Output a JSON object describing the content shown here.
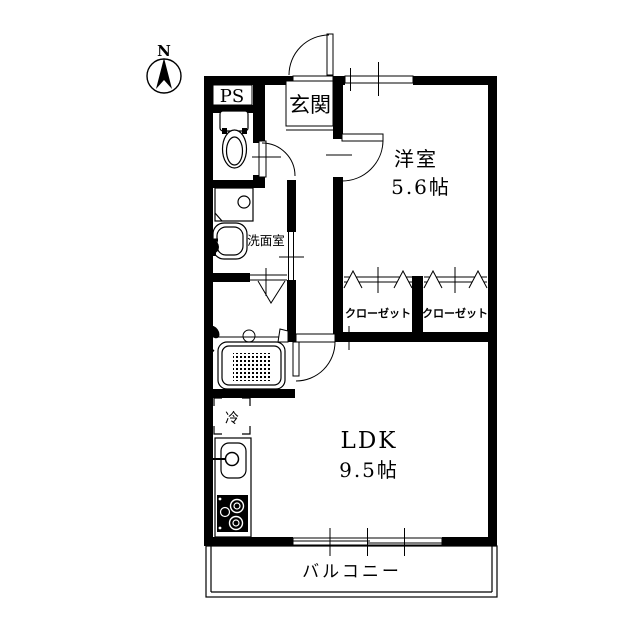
{
  "compass": {
    "label": "N"
  },
  "labels": {
    "ps": "PS",
    "entrance": "玄関",
    "western_room_name": "洋室",
    "western_room_size": "5.6帖",
    "washroom": "洗面室",
    "closet_left": "クローゼット",
    "closet_right": "クローゼット",
    "ldk_name": "LDK",
    "ldk_size": "9.5帖",
    "balcony": "バルコニー",
    "refrigerator": "冷"
  },
  "colors": {
    "line": "#000000",
    "background": "#ffffff"
  }
}
